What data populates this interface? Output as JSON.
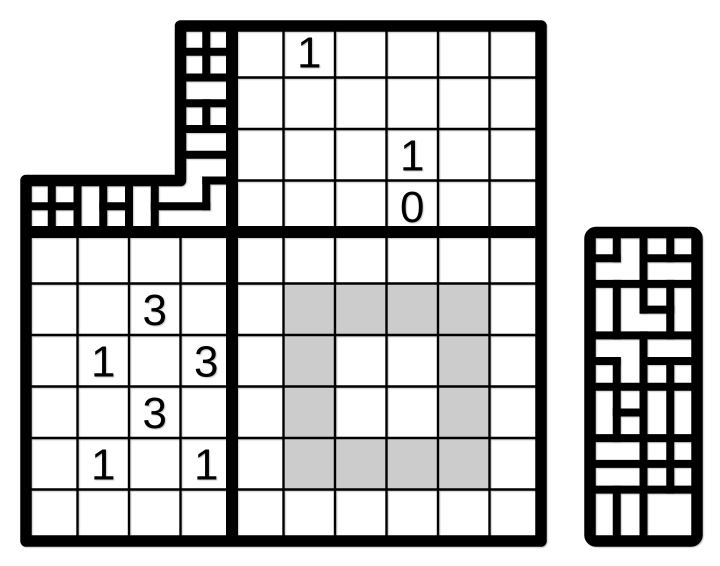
{
  "canvas": {
    "width": 720,
    "height": 566,
    "background": "#ffffff",
    "line_color": "#000000",
    "shade_color": "#cccccc"
  },
  "geometry": {
    "cell": 51.5,
    "thick": 11.5,
    "separator": 12,
    "wall": 8,
    "thin": 2.4,
    "clue_font_size": 44,
    "clue_baseline_offset": 15.5,
    "right_border_radius": 6
  },
  "grids": {
    "top": {
      "x": 232,
      "y": 26,
      "cols": 6,
      "rows": 4,
      "clues": [
        {
          "row": 0,
          "col": 1,
          "value": "1"
        },
        {
          "row": 2,
          "col": 3,
          "value": "1"
        },
        {
          "row": 3,
          "col": 3,
          "value": "0"
        }
      ]
    },
    "bottom_left": {
      "x": 26,
      "y": 232,
      "cols": 4,
      "rows": 6,
      "clues": [
        {
          "row": 1,
          "col": 2,
          "value": "3"
        },
        {
          "row": 2,
          "col": 1,
          "value": "1"
        },
        {
          "row": 2,
          "col": 3,
          "value": "3"
        },
        {
          "row": 3,
          "col": 2,
          "value": "3"
        },
        {
          "row": 4,
          "col": 1,
          "value": "1"
        },
        {
          "row": 4,
          "col": 3,
          "value": "1"
        }
      ]
    },
    "bottom_right": {
      "x": 232,
      "y": 232,
      "cols": 6,
      "rows": 6,
      "shaded": [
        [
          1,
          1
        ],
        [
          2,
          1
        ],
        [
          3,
          1
        ],
        [
          4,
          1
        ],
        [
          1,
          2
        ],
        [
          4,
          2
        ],
        [
          1,
          3
        ],
        [
          4,
          3
        ],
        [
          1,
          4
        ],
        [
          2,
          4
        ],
        [
          3,
          4
        ],
        [
          4,
          4
        ]
      ]
    }
  },
  "outline": {
    "points": [
      [
        180.5,
        26
      ],
      [
        541,
        26
      ],
      [
        541,
        541
      ],
      [
        26,
        541
      ],
      [
        26,
        180.5
      ],
      [
        180.5,
        180.5
      ]
    ]
  },
  "separators": [
    [
      232,
      26,
      232,
      541
    ],
    [
      26,
      232,
      541,
      232
    ]
  ],
  "maze_corner": {
    "x0": 26,
    "y0": 26,
    "pitch_x": 25.75,
    "pitch_y": 25.75,
    "v_walls": [
      [
        7,
        0,
        2
      ],
      [
        7,
        3,
        4
      ],
      [
        7,
        6,
        7
      ],
      [
        1,
        6,
        8
      ],
      [
        2,
        6,
        8
      ],
      [
        3,
        6,
        8
      ],
      [
        4,
        6,
        8
      ],
      [
        5,
        6,
        8
      ]
    ],
    "h_walls": [
      [
        1,
        6,
        8
      ],
      [
        2,
        6,
        8
      ],
      [
        3,
        6,
        8
      ],
      [
        4,
        6,
        8
      ],
      [
        5,
        6,
        8
      ],
      [
        6,
        7,
        8
      ],
      [
        7,
        0,
        2
      ],
      [
        7,
        3,
        4
      ],
      [
        7,
        5,
        7
      ]
    ]
  },
  "maze_right": {
    "x0": 590,
    "y0": 232.5,
    "pitch_x": 26.75,
    "pitch_y": 25.708,
    "cols": 4,
    "rows": 12,
    "v_walls": [
      [
        1,
        0,
        1
      ],
      [
        1,
        2,
        4
      ],
      [
        1,
        5,
        8
      ],
      [
        1,
        10,
        12
      ],
      [
        2,
        0,
        3
      ],
      [
        2,
        4,
        12
      ],
      [
        3,
        0,
        1
      ],
      [
        3,
        2,
        4
      ],
      [
        3,
        5,
        10
      ]
    ],
    "h_walls": [
      [
        1,
        0,
        1
      ],
      [
        1,
        2,
        4
      ],
      [
        2,
        0,
        4
      ],
      [
        3,
        2,
        3
      ],
      [
        4,
        0,
        4
      ],
      [
        5,
        0,
        1
      ],
      [
        5,
        2,
        4
      ],
      [
        6,
        0,
        4
      ],
      [
        7,
        1,
        2
      ],
      [
        8,
        0,
        4
      ],
      [
        9,
        0,
        4
      ],
      [
        10,
        0,
        4
      ]
    ]
  }
}
